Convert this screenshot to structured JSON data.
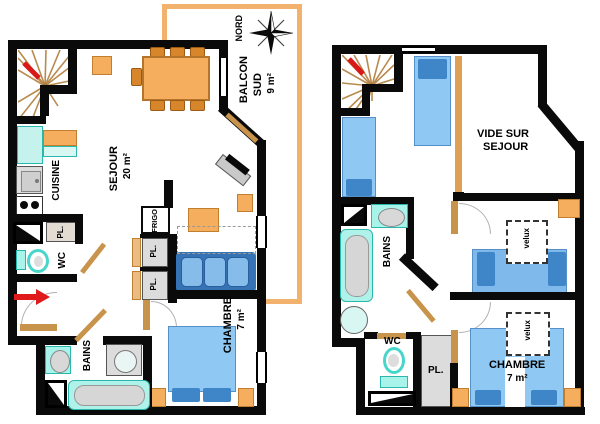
{
  "meta": {
    "type": "apartment floor plan",
    "floors": 2
  },
  "colors": {
    "wall": "#0a0a0a",
    "wood_balcony": "#F2B26E",
    "furniture_orange": "#F4AE5E",
    "door_wood": "#C8944B",
    "bed_light_blue": "#8FC8F2",
    "bed_dark_blue": "#3E86C8",
    "sanitary_cyan": "#A8F3EA",
    "appliance_gray": "#DCDCDC",
    "accent_red": "#E01A1A"
  },
  "ground_floor": {
    "balcony": {
      "name_line1": "BALCON",
      "name_line2": "SUD",
      "area": "9 m²"
    },
    "compass": {
      "north_label": "NORD"
    },
    "sejour": {
      "name": "SEJOUR",
      "area": "20 m²"
    },
    "cuisine": {
      "name": "CUISINE"
    },
    "frigo": {
      "name": "FRIGO"
    },
    "closet1": {
      "name": "PL."
    },
    "closet2": {
      "name": "PL."
    },
    "closet3": {
      "name": "PL."
    },
    "wc": {
      "name": "WC"
    },
    "bains": {
      "name": "BAINS"
    },
    "chambre": {
      "name": "CHAMBRE",
      "area": "7 m²"
    }
  },
  "upper_floor": {
    "vide": {
      "name_line1": "VIDE SUR",
      "name_line2": "SEJOUR"
    },
    "bains": {
      "name": "BAINS"
    },
    "wc": {
      "name": "WC"
    },
    "closet": {
      "name": "PL."
    },
    "chambre": {
      "name": "CHAMBRE",
      "area": "7 m²"
    },
    "velux1": {
      "name": "velux"
    },
    "velux2": {
      "name": "velux"
    }
  }
}
